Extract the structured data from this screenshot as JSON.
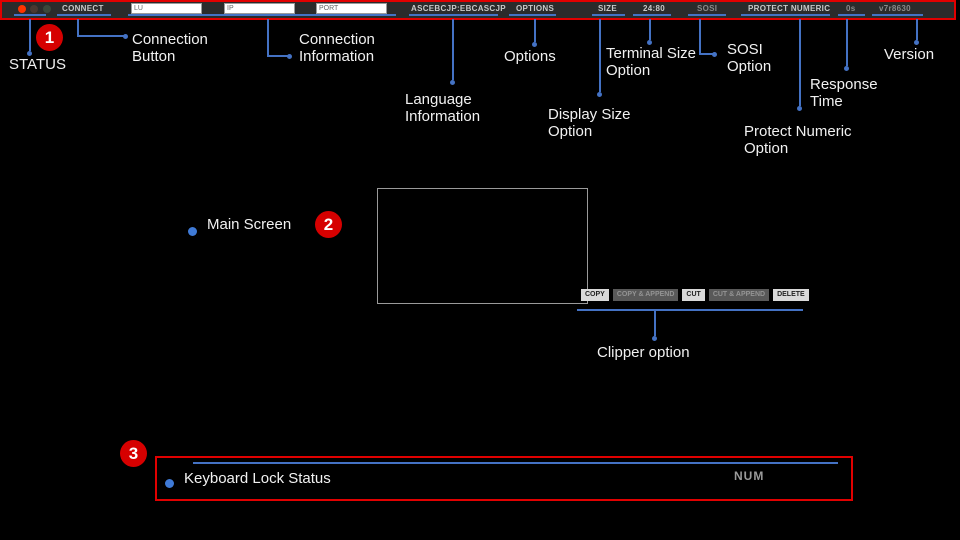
{
  "colors": {
    "annotation_red": "#d60000",
    "annotation_blue": "#4472c4",
    "bullet_blue": "#3f7ad6",
    "toolbar_bg": "#2b2b2b"
  },
  "toolbar": {
    "connect_label": "CONNECT",
    "lu_placeholder": "LU",
    "ip_placeholder": "IP",
    "port_placeholder": "PORT",
    "language_info": "ASCEBCJP:EBCASCJP",
    "options_label": "OPTIONS",
    "size_label": "SIZE",
    "terminal_size": "24:80",
    "sosi_label": "SOSI",
    "protect_numeric_label": "PROTECT NUMERIC",
    "response_time": "0s",
    "version": "v7r8630"
  },
  "annotations": {
    "markers": {
      "one": "1",
      "two": "2",
      "three": "3"
    },
    "labels": {
      "status": "STATUS",
      "connection_button": "Connection Button",
      "connection_information": "Connection Information",
      "language_information": "Language Information",
      "options": "Options",
      "display_size_option": "Display Size Option",
      "terminal_size_option": "Terminal Size Option",
      "sosi_option": "SOSI Option",
      "protect_numeric_option": "Protect Numeric Option",
      "response_time": "Response Time",
      "version": "Version",
      "main_screen": "Main Screen",
      "clipper_option": "Clipper option",
      "keyboard_lock_status": "Keyboard Lock Status"
    }
  },
  "clipper": {
    "buttons": [
      {
        "label": "COPY",
        "enabled": true
      },
      {
        "label": "COPY & APPEND",
        "enabled": false
      },
      {
        "label": "CUT",
        "enabled": true
      },
      {
        "label": "CUT & APPEND",
        "enabled": false
      },
      {
        "label": "DELETE",
        "enabled": true
      }
    ]
  },
  "statusbar": {
    "num_indicator": "NUM"
  }
}
